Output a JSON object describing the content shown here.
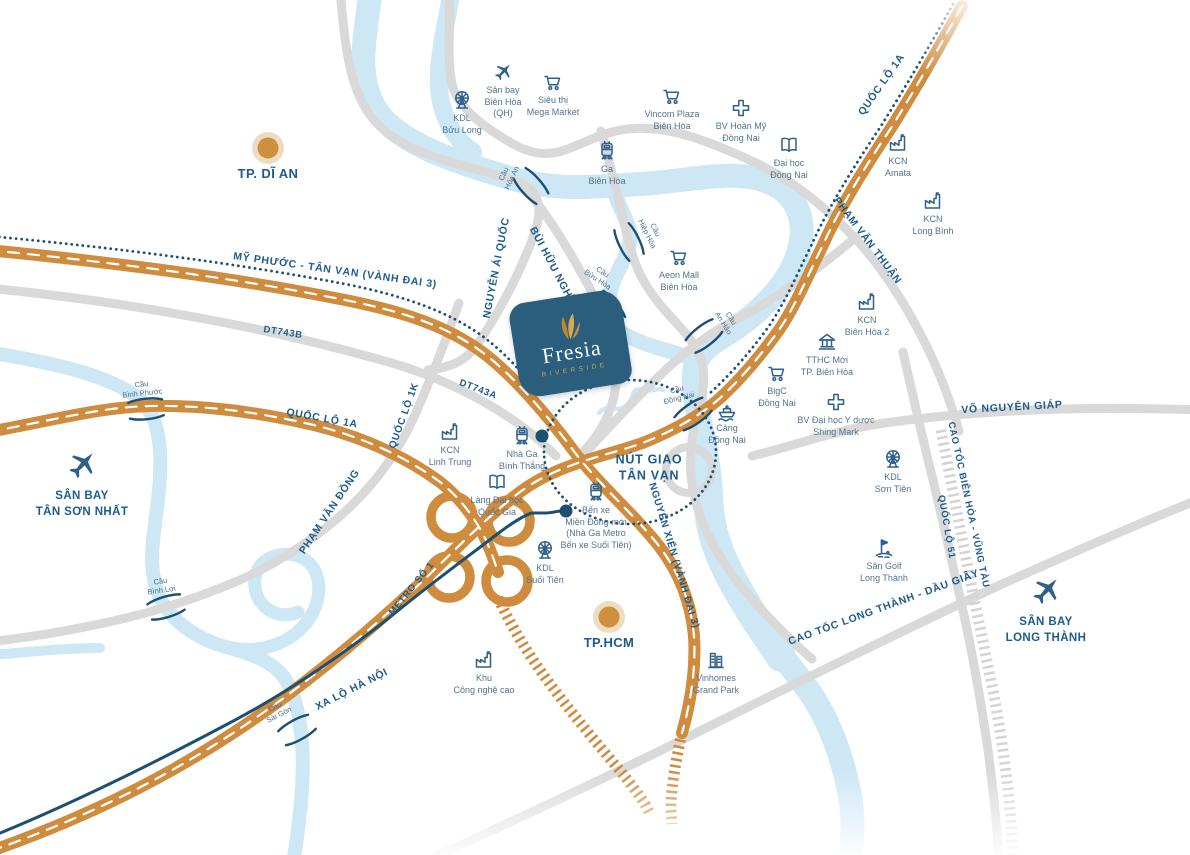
{
  "project": {
    "name": "Fresia",
    "subtitle": "RIVERSIDE"
  },
  "colors": {
    "highway_orange": "#cf8c3f",
    "road_gray": "#d9d9d9",
    "river_blue": "#cde7f5",
    "label_blue": "#1d5b8c",
    "poi_blue": "#2e608c",
    "metro_navy": "#1d5070",
    "logo_teal": "#2b5e7d",
    "logo_gold": "#d0a250"
  },
  "cities": [
    {
      "id": "tp-di-an",
      "label": "TP. DĨ AN",
      "x": 268,
      "y": 148
    },
    {
      "id": "tp-hcm",
      "label": "TP.HCM",
      "x": 609,
      "y": 617
    }
  ],
  "airports": [
    {
      "id": "san-bay-tan-son-nhat",
      "label": "SÂN BAY\nTÂN SƠN NHẤT",
      "x": 82,
      "y": 446
    },
    {
      "id": "san-bay-long-thanh",
      "label": "SÂN BAY\nLONG THÀNH",
      "x": 1046,
      "y": 572
    }
  ],
  "pois": [
    {
      "id": "kdl-buu-long",
      "icon": "ferris-wheel-icon",
      "label": "KDL\nBửu Long",
      "x": 462,
      "y": 88
    },
    {
      "id": "san-bay-bien-hoa",
      "icon": "plane-icon",
      "label": "Sân bay\nBiên Hòa\n(QH)",
      "x": 503,
      "y": 60
    },
    {
      "id": "sieu-thi-mega-market",
      "icon": "cart-icon",
      "label": "Siêu thị\nMega Market",
      "x": 553,
      "y": 70
    },
    {
      "id": "vincom-plaza",
      "icon": "cart-icon",
      "label": "Vincom Plaza\nBiên Hòa",
      "x": 672,
      "y": 84
    },
    {
      "id": "bv-hoan-my",
      "icon": "cross-icon",
      "label": "BV Hoàn Mỹ\nĐồng Nai",
      "x": 741,
      "y": 96
    },
    {
      "id": "dai-hoc-dong-nai",
      "icon": "book-icon",
      "label": "Đại học\nĐồng Nai",
      "x": 789,
      "y": 133
    },
    {
      "id": "kcn-amata",
      "icon": "factory-icon",
      "label": "KCN\nAmata",
      "x": 898,
      "y": 131
    },
    {
      "id": "kcn-long-binh",
      "icon": "factory-icon",
      "label": "KCN\nLong Bình",
      "x": 933,
      "y": 189
    },
    {
      "id": "ga-bien-hoa",
      "icon": "train-icon",
      "label": "Ga\nBiên Hòa",
      "x": 607,
      "y": 139
    },
    {
      "id": "aeon-mall",
      "icon": "cart-icon",
      "label": "Aeon Mall\nBiên Hòa",
      "x": 679,
      "y": 245
    },
    {
      "id": "kcn-bien-hoa-2",
      "icon": "factory-icon",
      "label": "KCN\nBiên Hòa 2",
      "x": 867,
      "y": 290
    },
    {
      "id": "tthc-moi",
      "icon": "bank-icon",
      "label": "TTHC Mới\nTP. Biên Hòa",
      "x": 827,
      "y": 330
    },
    {
      "id": "bigc-dong-nai",
      "icon": "cart-icon",
      "label": "BigC\nĐồng Nai",
      "x": 777,
      "y": 361
    },
    {
      "id": "bv-shing-mark",
      "icon": "cross-icon",
      "label": "BV Đại học Y dược\nShing Mark",
      "x": 836,
      "y": 390
    },
    {
      "id": "cang-dong-nai",
      "icon": "ship-icon",
      "label": "Cảng\nĐồng Nai",
      "x": 727,
      "y": 398
    },
    {
      "id": "kcn-linh-trung",
      "icon": "factory-icon",
      "label": "KCN\nLinh Trung",
      "x": 450,
      "y": 420
    },
    {
      "id": "nha-ga-binh-thang",
      "icon": "train-icon",
      "label": "Nhà Ga\nBình Thắng",
      "x": 522,
      "y": 424
    },
    {
      "id": "lang-dai-hoc",
      "icon": "book-icon",
      "label": "Làng Đại học\nQuốc Gia",
      "x": 497,
      "y": 470
    },
    {
      "id": "ben-xe-mien-dong",
      "icon": "train-icon",
      "label": "Bến xe\nMiền Đông mới\n(Nhà Ga Metro\nBến xe Suối Tiên)",
      "x": 596,
      "y": 480
    },
    {
      "id": "kdl-suoi-tien",
      "icon": "ferris-wheel-icon",
      "label": "KDL\nSuối Tiên",
      "x": 545,
      "y": 538
    },
    {
      "id": "kdl-son-tien",
      "icon": "ferris-wheel-icon",
      "label": "KDL\nSơn Tiên",
      "x": 893,
      "y": 447
    },
    {
      "id": "san-golf-long-thanh",
      "icon": "golf-icon",
      "label": "Sân Golf\nLong Thành",
      "x": 884,
      "y": 536
    },
    {
      "id": "khu-cong-nghe-cao",
      "icon": "factory-icon",
      "label": "Khu\nCông nghệ cao",
      "x": 484,
      "y": 648
    },
    {
      "id": "vinhomes-grand-park",
      "icon": "building-icon",
      "label": "Vinhomes\nGrand Park",
      "x": 716,
      "y": 648
    }
  ],
  "road_labels": [
    {
      "id": "my-phuoc-tan-van",
      "text": "MỸ PHƯỚC - TÂN VẠN (VÀNH ĐAI 3)",
      "x": 335,
      "y": 271,
      "rot": 8,
      "size": 10.5
    },
    {
      "id": "dt743b",
      "text": "DT743B",
      "x": 283,
      "y": 333,
      "rot": 9,
      "size": 9.5
    },
    {
      "id": "dt743a",
      "text": "DT743A",
      "x": 478,
      "y": 390,
      "rot": 21,
      "size": 9.5
    },
    {
      "id": "quoc-lo-1a-left",
      "text": "QUỐC LỘ 1A",
      "x": 322,
      "y": 419,
      "rot": 10,
      "size": 10.5
    },
    {
      "id": "quoc-lo-1k",
      "text": "QUỐC LỘ 1K",
      "x": 405,
      "y": 416,
      "rot": -70,
      "size": 10
    },
    {
      "id": "nguyen-ai-quoc",
      "text": "NGUYỄN ÁI QUỐC",
      "x": 497,
      "y": 268,
      "rot": -79,
      "size": 10.5
    },
    {
      "id": "bui-huu-nghia",
      "text": "BÙI HỮU NGHĨA",
      "x": 553,
      "y": 268,
      "rot": 62,
      "size": 10.5
    },
    {
      "id": "pham-van-thuan",
      "text": "PHẠM VĂN THUẬN",
      "x": 867,
      "y": 241,
      "rot": 53,
      "size": 10.5
    },
    {
      "id": "quoc-lo-1a-top",
      "text": "QUỐC LỘ 1A",
      "x": 882,
      "y": 85,
      "rot": -55,
      "size": 10.5
    },
    {
      "id": "pham-van-dong",
      "text": "PHẠM VĂN ĐỒNG",
      "x": 330,
      "y": 512,
      "rot": -56,
      "size": 10.5
    },
    {
      "id": "metro-so-1",
      "text": "METRO SỐ 1",
      "x": 412,
      "y": 589,
      "rot": -51,
      "size": 9.5
    },
    {
      "id": "xa-lo-ha-noi",
      "text": "XA LỘ HÀ NỘI",
      "x": 352,
      "y": 690,
      "rot": -27,
      "size": 10.5
    },
    {
      "id": "nguyen-xien",
      "text": "NGUYỄN XIỂN (VÀNH ĐAI 3)",
      "x": 673,
      "y": 556,
      "rot": 73,
      "size": 10
    },
    {
      "id": "nut-giao-tan-van",
      "text": "NÚT GIAO\nTÂN VẠN",
      "x": 649,
      "y": 468,
      "rot": 0,
      "size": 12.5
    },
    {
      "id": "cao-toc-long-thanh",
      "text": "CAO TỐC LONG THÀNH - DẦU GIÂY",
      "x": 884,
      "y": 608,
      "rot": -20,
      "size": 10.5
    },
    {
      "id": "vo-nguyen-giap",
      "text": "VÕ NGUYÊN GIÁP",
      "x": 1012,
      "y": 408,
      "rot": -3,
      "size": 10.5
    },
    {
      "id": "cao-toc-bien-hoa-vung-tau",
      "text": "CAO TỐC BIÊN HÒA - VŨNG TÀU",
      "x": 968,
      "y": 505,
      "rot": 78,
      "size": 9.5
    },
    {
      "id": "quoc-lo-51",
      "text": "QUỐC LỘ 51",
      "x": 946,
      "y": 527,
      "rot": 80,
      "size": 9.5
    }
  ],
  "bridges": [
    {
      "id": "cau-hoa-an",
      "label": "Cầu\nHóa An",
      "x": 531,
      "y": 186,
      "rot": 48,
      "lx": 508,
      "ly": 176,
      "lrot": -65
    },
    {
      "id": "cau-hiep-hoa",
      "label": "Cầu\nHiệp Hòa",
      "x": 629,
      "y": 242,
      "rot": 64,
      "lx": 651,
      "ly": 232,
      "lrot": 64
    },
    {
      "id": "cau-buu-hoa",
      "label": "Cầu\nBửu Hòa",
      "x": 608,
      "y": 309,
      "rot": 50,
      "lx": 600,
      "ly": 276,
      "lrot": 33
    },
    {
      "id": "cau-an-hao",
      "label": "Cầu\nAn Hảo",
      "x": 704,
      "y": 336,
      "rot": -38,
      "lx": 727,
      "ly": 321,
      "lrot": 58
    },
    {
      "id": "cau-dong-nai",
      "label": "Cầu\nĐồng Nai",
      "x": 693,
      "y": 414,
      "rot": -35,
      "lx": 678,
      "ly": 394,
      "lrot": -14
    },
    {
      "id": "cau-binh-phuoc",
      "label": "Cầu\nBình Phước",
      "x": 146,
      "y": 409,
      "rot": -6,
      "lx": 142,
      "ly": 389,
      "lrot": -6
    },
    {
      "id": "cau-binh-loi",
      "label": "Cầu\nBình Lợi",
      "x": 166,
      "y": 607,
      "rot": -17,
      "lx": 161,
      "ly": 586,
      "lrot": -8
    },
    {
      "id": "cau-sai-gon",
      "label": "Cầu\nSài Gòn",
      "x": 297,
      "y": 730,
      "rot": -29,
      "lx": 277,
      "ly": 711,
      "lrot": -27
    }
  ],
  "metro_stations": [
    {
      "id": "station-binh-thang",
      "x": 542,
      "y": 436
    },
    {
      "id": "station-suoi-tien",
      "x": 566,
      "y": 511
    }
  ]
}
